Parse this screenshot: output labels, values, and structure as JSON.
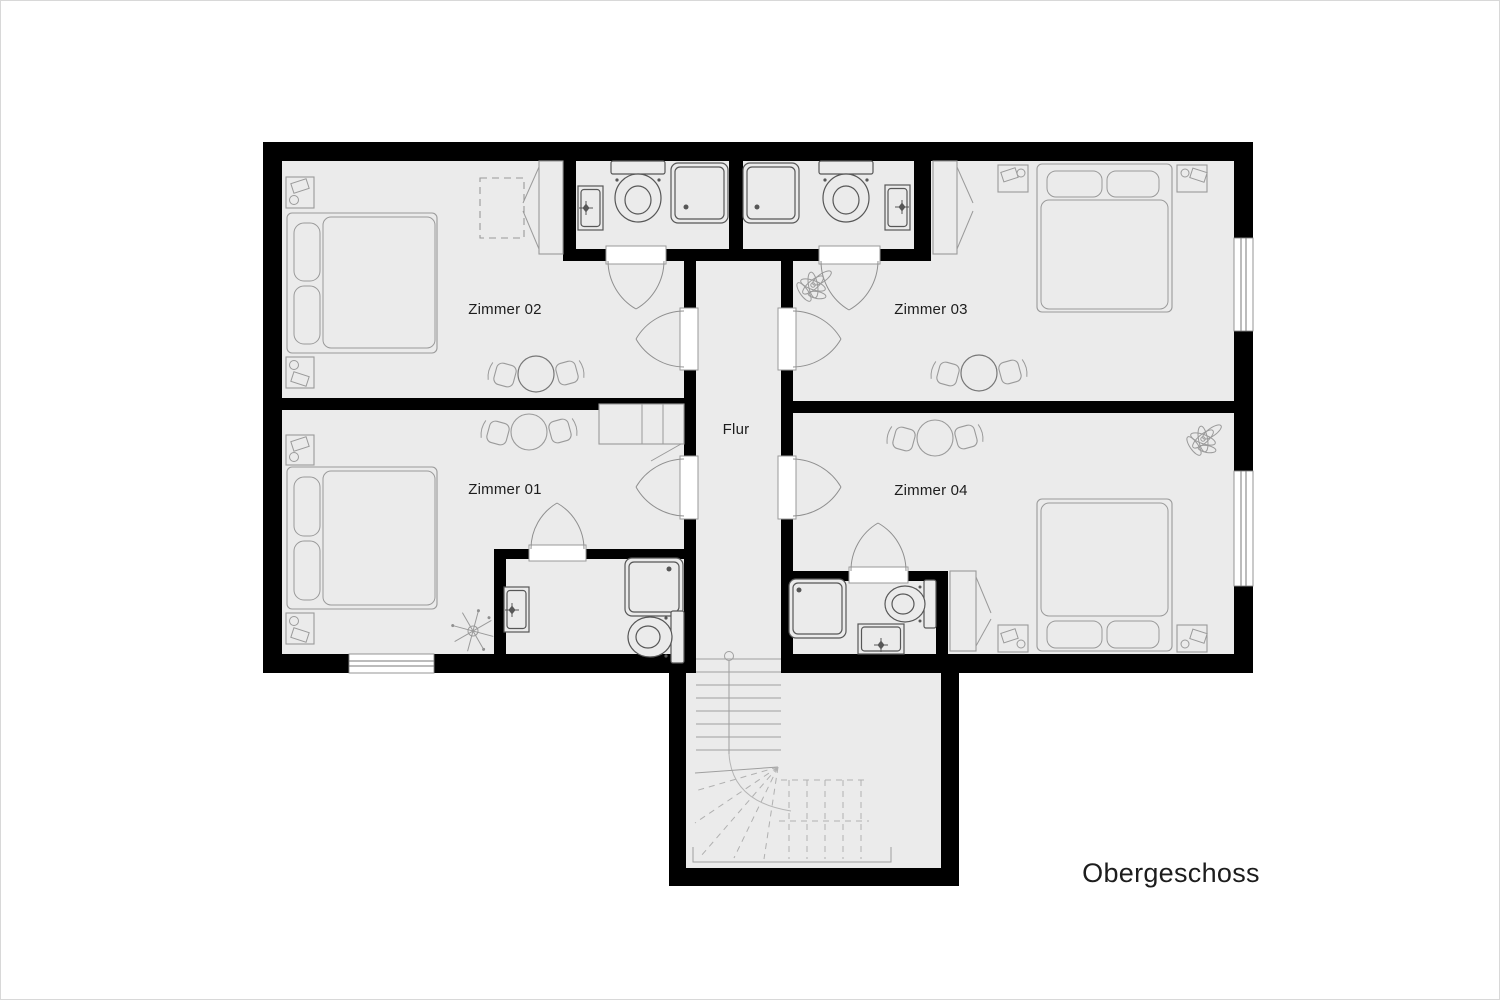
{
  "plan_title": "Obergeschoss",
  "rooms": [
    {
      "name": "Zimmer 02"
    },
    {
      "name": "Zimmer 03"
    },
    {
      "name": "Zimmer 01"
    },
    {
      "name": "Zimmer 04"
    },
    {
      "name": "Flur"
    }
  ],
  "colors": {
    "wall": "#000000",
    "floor": "#ebebeb",
    "background": "#ffffff",
    "furniture_line": "#9a9a9a",
    "fixture_line": "#575757",
    "text": "#1d1d1d"
  }
}
